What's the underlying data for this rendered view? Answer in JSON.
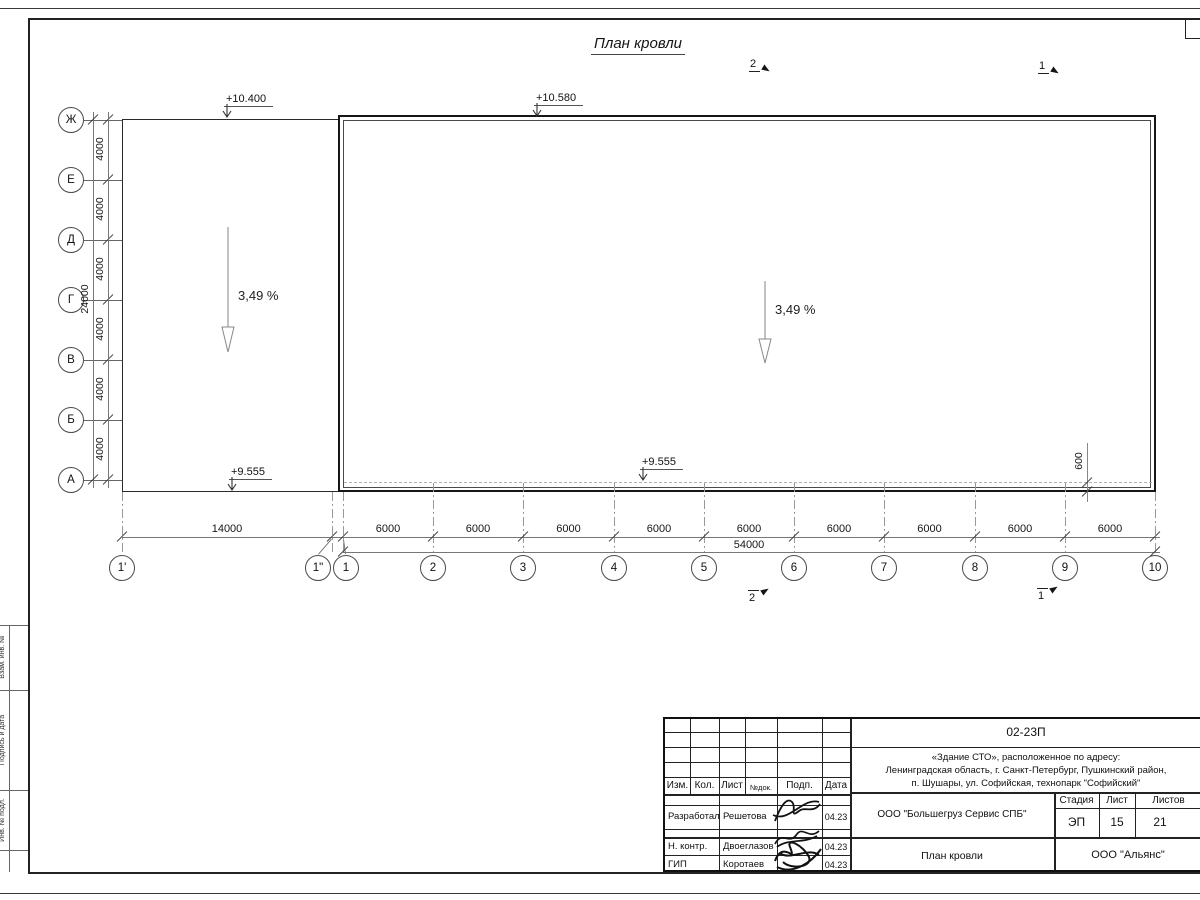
{
  "drawing": {
    "title": "План кровли",
    "slope_label": "3,49 %",
    "elevations": {
      "top_left": "+10.400",
      "top_right": "+10.580",
      "bottom_left": "+9.555",
      "bottom_right": "+9.555"
    },
    "parapet_dim": "600",
    "axes_left": [
      "Ж",
      "Е",
      "Д",
      "Г",
      "В",
      "Б",
      "А"
    ],
    "left_bay_dim": "4000",
    "left_total_dim": "24000",
    "axes_bottom": [
      "1'",
      "1\"",
      "1",
      "2",
      "3",
      "4",
      "5",
      "6",
      "7",
      "8",
      "9",
      "10"
    ],
    "bottom_first_dim": "14000",
    "bottom_bay_dim": "6000",
    "bottom_total_dim": "54000",
    "section_marks": {
      "top": [
        "2",
        "1"
      ],
      "bottom": [
        "2",
        "1"
      ]
    }
  },
  "frame_strip": {
    "labels": [
      "Взам. инв. №",
      "Подпись и дата",
      "Инв. № подл."
    ]
  },
  "title_block": {
    "code": "02-23П",
    "address_lines": [
      "«Здание СТО», расположенное по адресу:",
      "Ленинградская область, г. Санкт-Петербург, Пушкинский район,",
      "п. Шушары, ул. Софийская, технопарк \"Софийский\""
    ],
    "header_cells": [
      "Изм.",
      "Кол.",
      "Лист",
      "№док.",
      "Подп.",
      "Дата"
    ],
    "rows": [
      {
        "role": "Разработал",
        "name": "Решетова",
        "date": "04.23"
      },
      {
        "role": "Н. контр.",
        "name": "Двоеглазов",
        "date": "04.23"
      },
      {
        "role": "ГИП",
        "name": "Коротаев",
        "date": "04.23"
      }
    ],
    "org": "ООО \"Большегруз Сервис СПБ\"",
    "stage_labels": [
      "Стадия",
      "Лист",
      "Листов"
    ],
    "stage_values": [
      "ЭП",
      "15",
      "21"
    ],
    "doc_title": "План кровли",
    "company": "ООО \"Альянс\""
  },
  "colors": {
    "line": "#2a2a2a",
    "dim_line": "#777777",
    "dashed_line": "#b0b0b0"
  }
}
